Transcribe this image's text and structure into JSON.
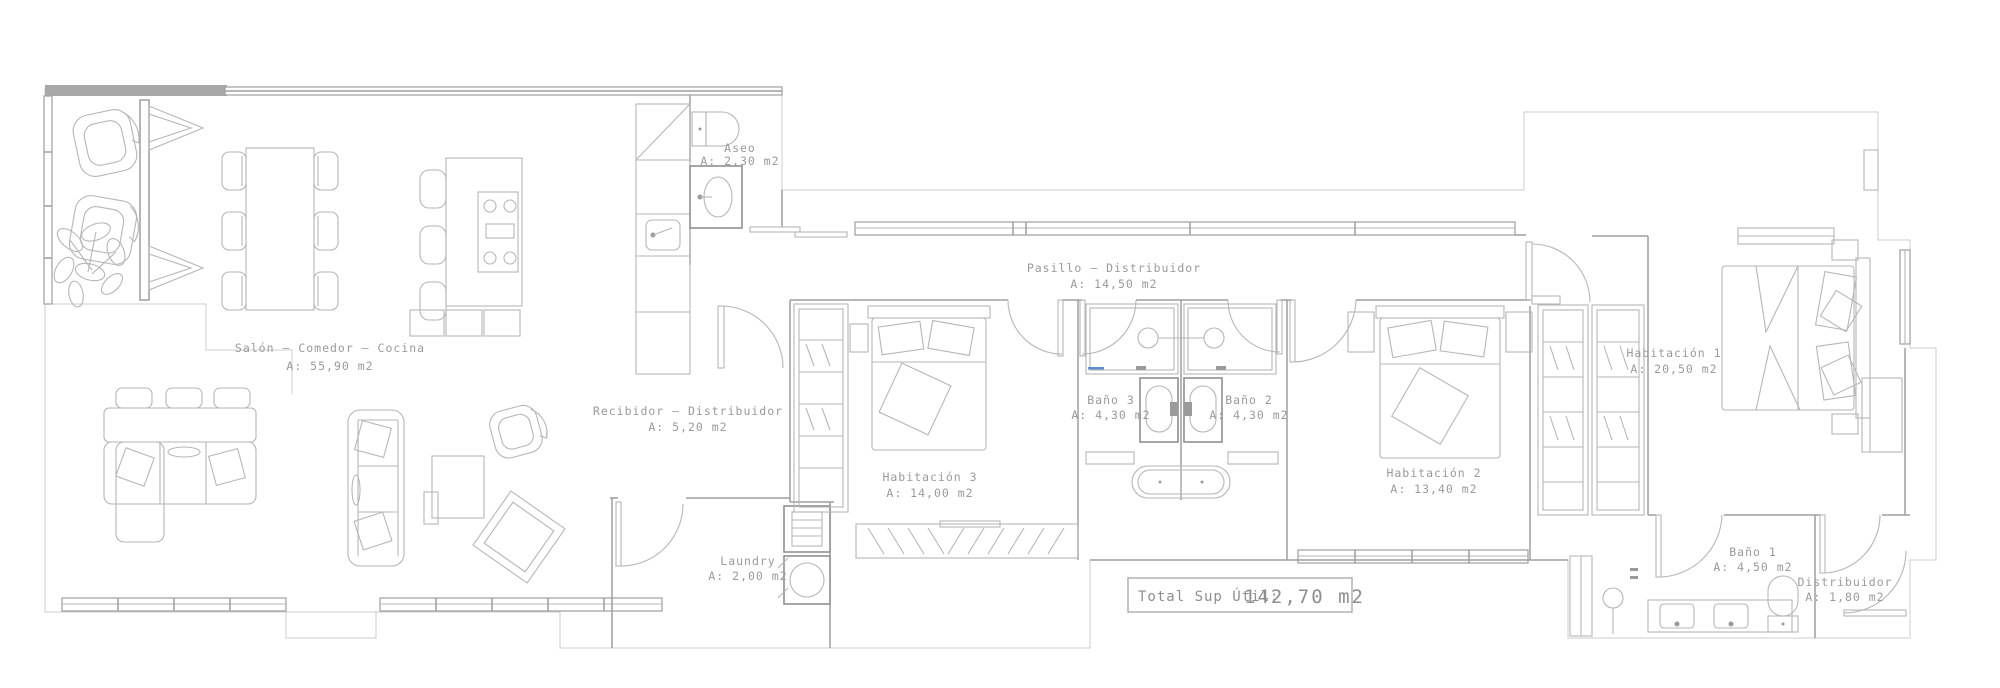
{
  "plan": {
    "title": "Apartment floor plan",
    "rooms": [
      {
        "id": "salon",
        "name": "Salón — Comedor — Cocina",
        "area": "A: 55,90 m2"
      },
      {
        "id": "aseo",
        "name": "Aseo",
        "area": "A: 2,30 m2"
      },
      {
        "id": "pasillo",
        "name": "Pasillo — Distribuidor",
        "area": "A: 14,50 m2"
      },
      {
        "id": "recibidor",
        "name": "Recibidor — Distribuidor",
        "area": "A: 5,20 m2"
      },
      {
        "id": "habitacion3",
        "name": "Habitación 3",
        "area": "A: 14,00 m2"
      },
      {
        "id": "bano3",
        "name": "Baño 3",
        "area": "A: 4,30 m2"
      },
      {
        "id": "bano2",
        "name": "Baño 2",
        "area": "A: 4,30 m2"
      },
      {
        "id": "habitacion2",
        "name": "Habitación 2",
        "area": "A: 13,40 m2"
      },
      {
        "id": "habitacion1",
        "name": "Habitación 1",
        "area": "A: 20,50 m2"
      },
      {
        "id": "laundry",
        "name": "Laundry",
        "area": "A: 2,00 m2"
      },
      {
        "id": "bano1",
        "name": "Baño 1",
        "area": "A: 4,50 m2"
      },
      {
        "id": "distribuidor",
        "name": "Distribuidor",
        "area": "A: 1,80 m2"
      }
    ],
    "total": {
      "label": "Total Sup Útil:",
      "value": "142,70 m2"
    },
    "colors": {
      "background": "#ffffff",
      "wall": "#9e9e9e",
      "thin_contour": "#cccccc",
      "furniture": "#b6b6b6",
      "fixture_dark": "#8f8f8f",
      "text": "#9a9a9a",
      "accent_blue": "#5b8fd4"
    }
  }
}
